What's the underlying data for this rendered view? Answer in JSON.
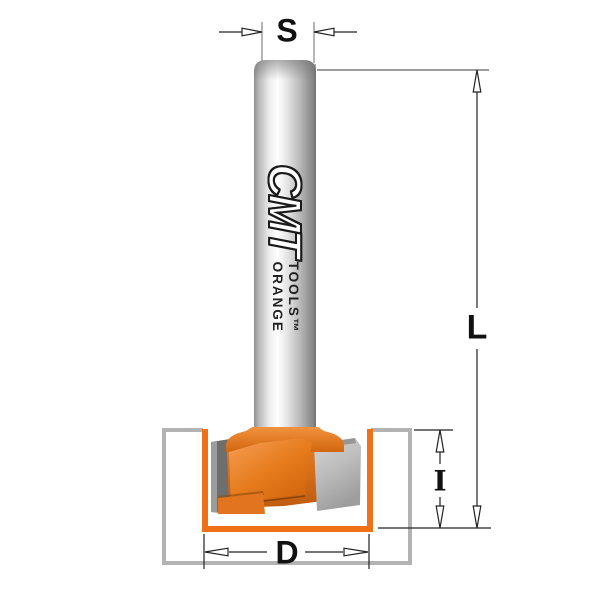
{
  "diagram": {
    "title": "router-bit-dimension-diagram",
    "brand": {
      "logo": "CMT",
      "line1": "ORANGE",
      "line2": "TOOLS™"
    },
    "labels": {
      "shank_diameter": "S",
      "overall_length": "L",
      "cutting_depth": "I",
      "cutting_diameter": "D"
    },
    "colors": {
      "accent_orange": "#EE7117",
      "workpiece_outline": "#B3B3B3",
      "dimension_line": "#222222",
      "steel_light": "#E8E8E8",
      "carbide_gray": "#B9B9B9"
    }
  }
}
